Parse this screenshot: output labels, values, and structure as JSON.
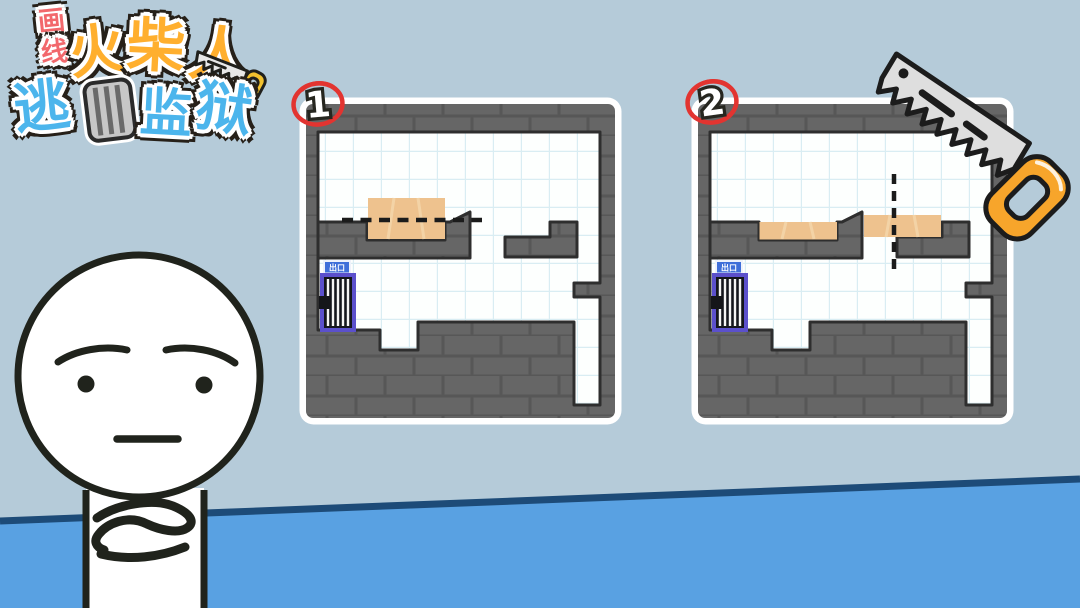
{
  "title_logo": {
    "full_title": "画线火柴人逃亡监狱",
    "prefix_chars": [
      "画",
      "线"
    ],
    "main_chars": [
      "火",
      "柴",
      "人"
    ],
    "cage_char": "亡",
    "suffix_chars": [
      "逃",
      "监",
      "狱"
    ],
    "prefix_color": "#f2686c",
    "main_color": "#ffaf2e",
    "suffix_color": "#4cb5ec"
  },
  "panels": [
    {
      "badge": "1",
      "door_sign": "出口",
      "cut_line_orientation": "horizontal"
    },
    {
      "badge": "2",
      "door_sign": "出口",
      "cut_line_orientation": "vertical"
    }
  ],
  "icons": {
    "saw": "hand-saw-icon",
    "cage": "jail-cage-icon",
    "character": "thinking-stickman"
  },
  "colors": {
    "background": "#b5cbd9",
    "floor": "#59a1e2",
    "floor_line": "#1d4b78",
    "wall_gray": "#666666",
    "wall_mortar": "#575757",
    "room_white": "#fdfffe",
    "grid_line": "#d9edf3",
    "outline_dark": "#2e2e2e",
    "plank_tan": "#eec28e",
    "door_frame_purple": "#5b50cc",
    "sign_blue": "#3f6fd9",
    "badge_red": "#e23430",
    "saw_blade": "#dedede",
    "saw_handle": "#f7a52b"
  }
}
